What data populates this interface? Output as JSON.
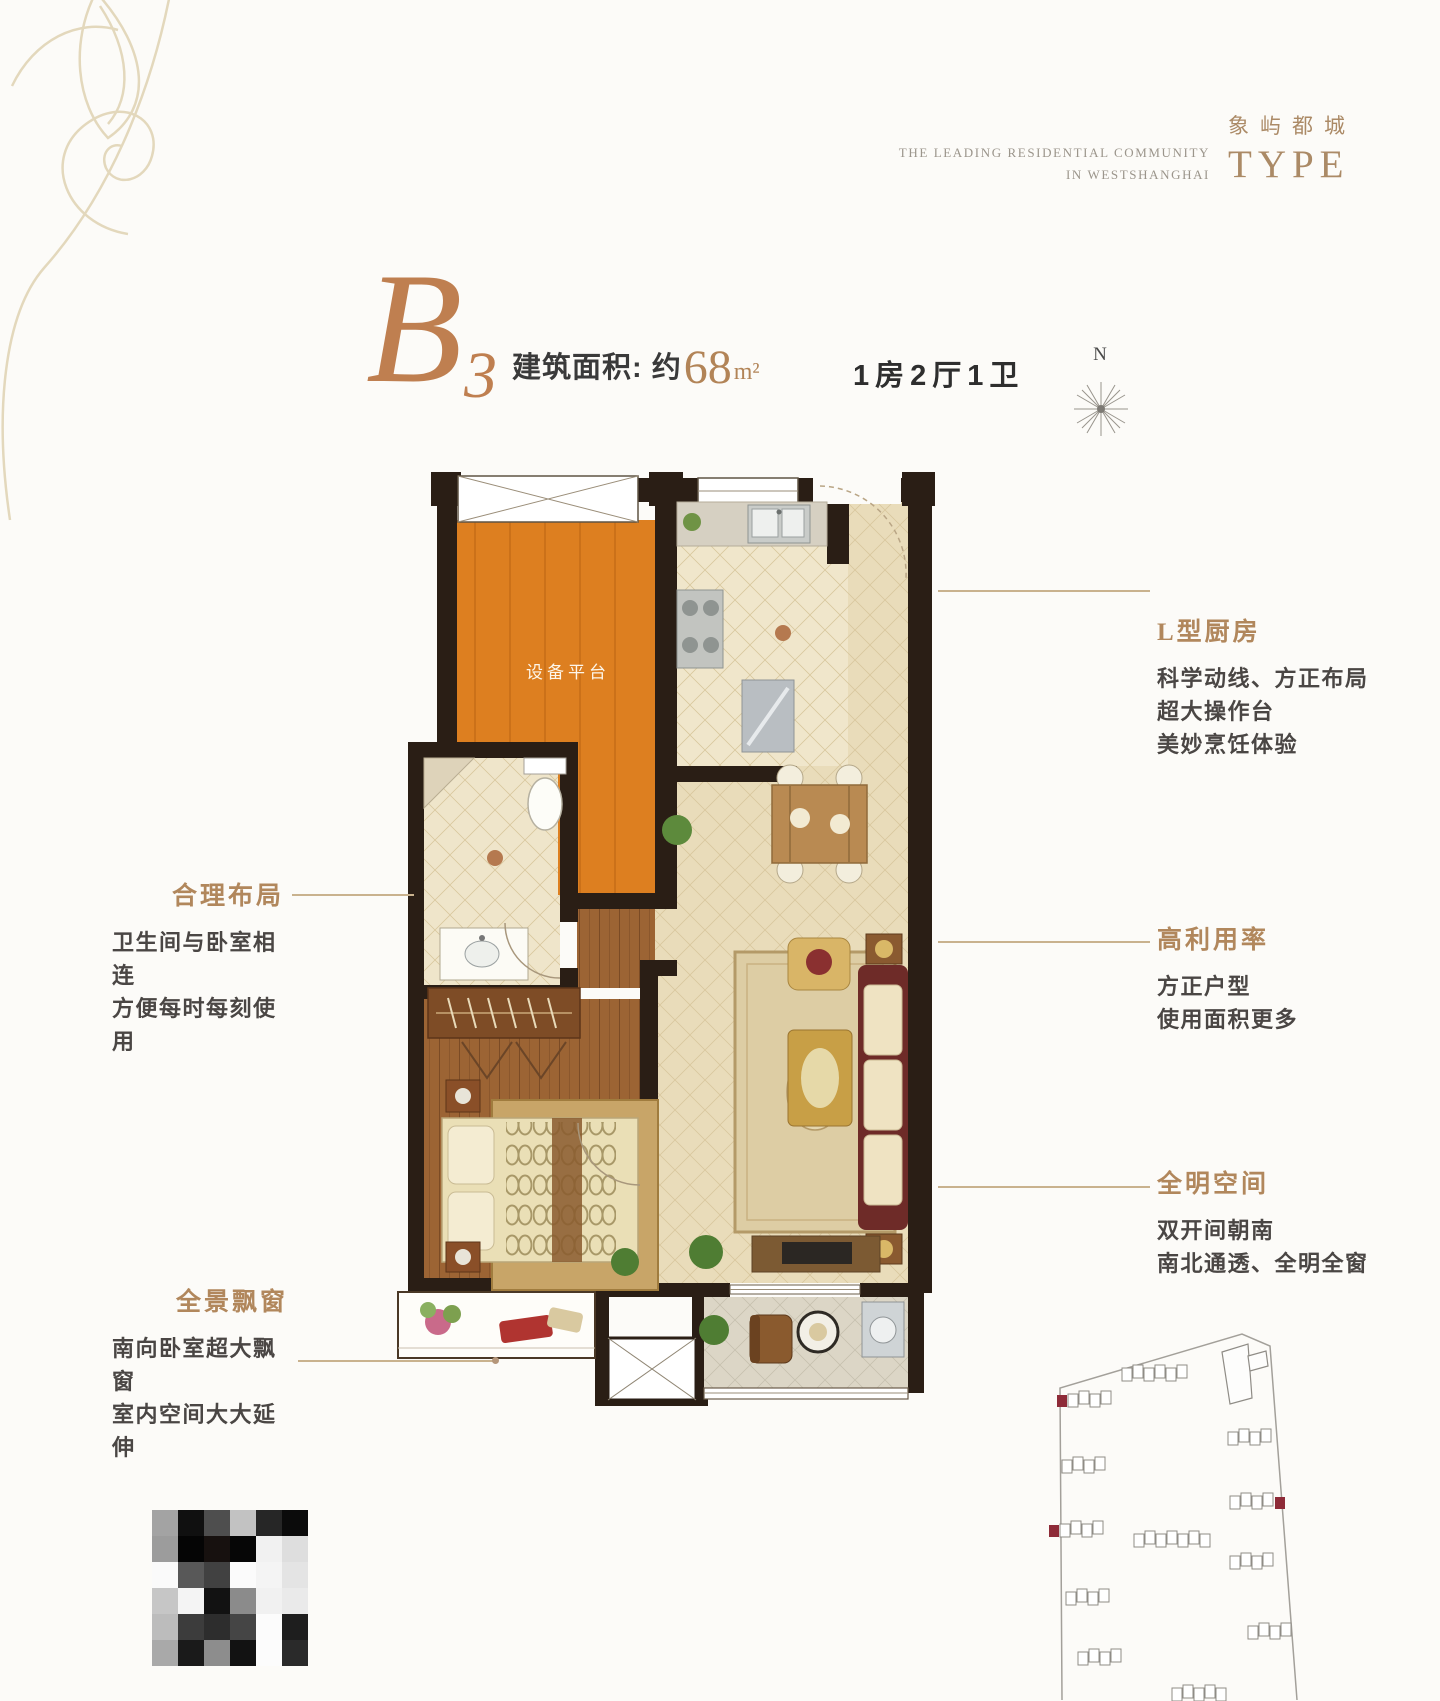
{
  "brand": {
    "tagline_line1": "THE LEADING RESIDENTIAL COMMUNITY",
    "tagline_line2": "IN WESTSHANGHAI",
    "logo_cn": "象屿都城",
    "logo_en": "TYPE"
  },
  "title": {
    "unit": "B",
    "unit_sub": "3",
    "area_label": "建筑面积: 约",
    "area_value": "68",
    "area_unit": "m²",
    "layout": "1房2厅1卫"
  },
  "compass": {
    "label": "N"
  },
  "plan": {
    "equipment_platform_label": "设备平台"
  },
  "annotations": {
    "left": [
      {
        "heading": "合理布局",
        "lines": [
          "卫生间与卧室相连",
          "方便每时每刻使用"
        ]
      },
      {
        "heading": "全景飘窗",
        "lines": [
          "南向卧室超大飘窗",
          "室内空间大大延伸"
        ]
      }
    ],
    "right": [
      {
        "heading": "L型厨房",
        "lines": [
          "科学动线、方正布局",
          "超大操作台",
          "美妙烹饪体验"
        ]
      },
      {
        "heading": "高利用率",
        "lines": [
          "方正户型",
          "使用面积更多"
        ]
      },
      {
        "heading": "全明空间",
        "lines": [
          "双开间朝南",
          "南北通透、全明全窗"
        ]
      }
    ]
  },
  "colors": {
    "accent_copper": "#b1875c",
    "wall": "#2a1e15",
    "equipment_platform": "#dd7f20",
    "highlight_red": "#8e2b38"
  },
  "qr_block": {
    "pixels": [
      [
        "#a3a3a3",
        "#101010",
        "#4e4e4e",
        "#c2c2c2",
        "#262626",
        "#0b0b0b"
      ],
      [
        "#9c9c9c",
        "#050505",
        "#17110f",
        "#060606",
        "#f1f1f1",
        "#dedede"
      ],
      [
        "#fafafa",
        "#585858",
        "#414141",
        "#fbfbfb",
        "#f4f4f4",
        "#e4e4e4"
      ],
      [
        "#c6c6c6",
        "#f4f4f4",
        "#121212",
        "#8b8b8b",
        "#f1f1f1",
        "#eaeaea"
      ],
      [
        "#bcbcbc",
        "#3c3c3c",
        "#2d2d2d",
        "#454545",
        "#fcfcfc",
        "#1e1e1e"
      ],
      [
        "#a9a9a9",
        "#1a1a1a",
        "#8d8d8d",
        "#121212",
        "#fcfcfc",
        "#2a2a2a"
      ]
    ]
  },
  "site_plan": {
    "highlight_color": "#8e2b38",
    "clusters": [
      {
        "x": 1068,
        "y": 1394,
        "n": 4,
        "red": "left"
      },
      {
        "x": 1122,
        "y": 1368,
        "n": 6,
        "red": "none"
      },
      {
        "x": 1228,
        "y": 1432,
        "n": 4,
        "red": "none"
      },
      {
        "x": 1062,
        "y": 1460,
        "n": 4,
        "red": "none"
      },
      {
        "x": 1230,
        "y": 1496,
        "n": 4,
        "red": "right"
      },
      {
        "x": 1060,
        "y": 1524,
        "n": 4,
        "red": "left"
      },
      {
        "x": 1134,
        "y": 1534,
        "n": 7,
        "red": "none"
      },
      {
        "x": 1230,
        "y": 1556,
        "n": 4,
        "red": "none"
      },
      {
        "x": 1066,
        "y": 1592,
        "n": 4,
        "red": "none"
      },
      {
        "x": 1248,
        "y": 1626,
        "n": 4,
        "red": "none"
      },
      {
        "x": 1078,
        "y": 1652,
        "n": 4,
        "red": "none"
      },
      {
        "x": 1172,
        "y": 1688,
        "n": 5,
        "red": "none"
      }
    ]
  }
}
